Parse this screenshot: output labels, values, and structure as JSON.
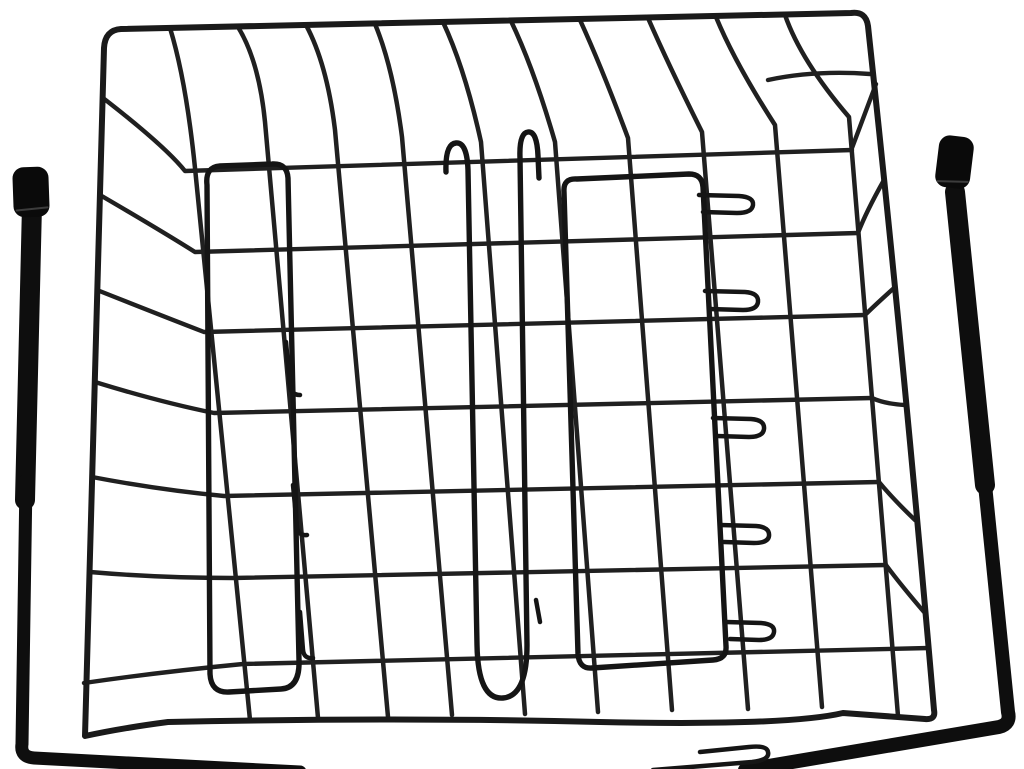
{
  "description": "Product photograph of a black metal wire rack basket shown tilted in three-quarter view on a plain white background, with two detached flat mounting rails with rounded end caps standing at the left and right sides",
  "object": {
    "type": "wire storage basket / dish drying rack",
    "material": "black powder-coated steel wire",
    "background": "plain white studio backdrop"
  },
  "colors": {
    "background": "#ffffff",
    "wire": "#202020",
    "rim": "#1a1a1a",
    "divider": "#151515",
    "rail": "#0e0e0e",
    "cap": "#0a0a0a",
    "cap_highlight": "#3c3c3c"
  },
  "structure": {
    "vertical_wires": 10,
    "horizontal_wires": 7,
    "left_wall_wires": 6,
    "right_wall_wires": 7,
    "divider_loops": 3,
    "clip_hooks": 6,
    "stub_prongs": 3,
    "mounting_rails": 2,
    "rail_end_caps": 2
  }
}
